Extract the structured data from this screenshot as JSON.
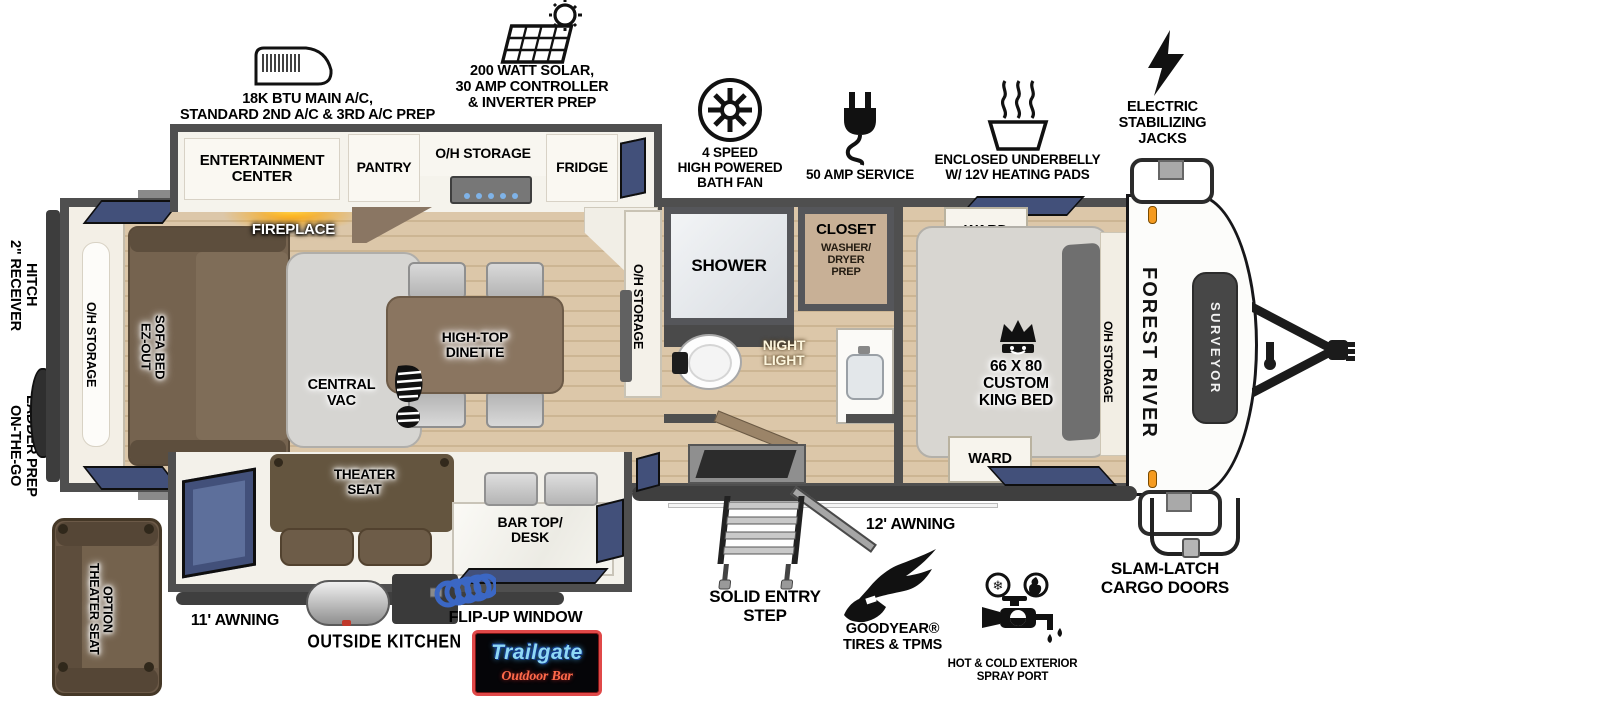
{
  "callouts": {
    "ac_text": "18K BTU MAIN A/C,\nSTANDARD 2ND A/C & 3RD A/C PREP",
    "solar_text": "200 WATT SOLAR,\n30 AMP CONTROLLER\n& INVERTER PREP",
    "bath_fan_text": "4 SPEED\nHIGH POWERED\nBATH FAN",
    "amp_service_text": "50 AMP SERVICE",
    "underbelly_text": "ENCLOSED UNDERBELLY\nW/ 12V HEATING PADS",
    "stab_jacks_text": "ELECTRIC\nSTABILIZING\nJACKS",
    "receiver_hitch_text": "2\" RECEIVER\nHITCH",
    "ladder_prep_text": "ON-THE-GO\nLADDER PREP",
    "awning_left_text": "11' AWNING",
    "outside_kitchen_text": "OUTSIDE KITCHEN",
    "flip_up_window_text": "FLIP-UP WINDOW",
    "entry_step_text": "SOLID ENTRY\nSTEP",
    "awning_right_text": "12' AWNING",
    "goodyear_text": "GOODYEAR®\nTIRES & TPMS",
    "spray_port_text": "HOT & COLD EXTERIOR\nSPRAY PORT",
    "cargo_doors_text": "SLAM-LATCH\nCARGO DOORS"
  },
  "rooms": {
    "entertainment_center": "ENTERTAINMENT\nCENTER",
    "pantry": "PANTRY",
    "oh_storage_kitchen": "O/H STORAGE",
    "fridge": "FRIDGE",
    "fireplace": "FIREPLACE",
    "oh_storage_rear": "O/H STORAGE",
    "sofa_bed": "EZ-OUT\nSOFA BED",
    "dinette": "HIGH-TOP\nDINETTE",
    "central_vac": "CENTRAL\nVAC",
    "oh_storage_mid": "O/H STORAGE",
    "shower": "SHOWER",
    "closet_title": "CLOSET",
    "closet_sub": "WASHER/\nDRYER\nPREP",
    "night_light": "NIGHT\nLIGHT",
    "ward_top": "WARD",
    "king_bed": "66 X 80\nCUSTOM\nKING BED",
    "oh_storage_bedroom": "O/H STORAGE",
    "ward_bottom": "WARD",
    "theater_seat": "THEATER\nSEAT",
    "bar_top_desk": "BAR TOP/\nDESK",
    "theater_seat_option": "THEATER SEAT\nOPTION"
  },
  "branding": {
    "make": "FOREST RIVER",
    "model": "SURVEYOR",
    "trailgate_title": "Trailgate",
    "trailgate_subtitle": "Outdoor Bar"
  },
  "icons": {
    "ac": "ac-unit-icon",
    "solar": "solar-panel-sun-icon",
    "bath_fan": "fan-icon",
    "amp": "power-plug-icon",
    "underbelly": "heated-pan-icon",
    "jacks": "lightning-bolt-icon",
    "king_bed": "crown-icon",
    "central_vac": "boot-print-icon",
    "entry_step": "step-ladder-icon",
    "goodyear": "winged-foot-icon",
    "spray_port": "faucet-hot-cold-icon",
    "outside_kitchen": "griddle-and-hose-icon",
    "hitch": "a-frame-hitch-icon"
  },
  "colors": {
    "wall": "#4f4f4f",
    "floor_wood": "#dcc7a9",
    "furniture_brown": "#75634f",
    "window_blue": "#42507a",
    "accent_orange": "#f59b20",
    "logo_blue": "#8fd8f5",
    "logo_red": "#e04848"
  }
}
